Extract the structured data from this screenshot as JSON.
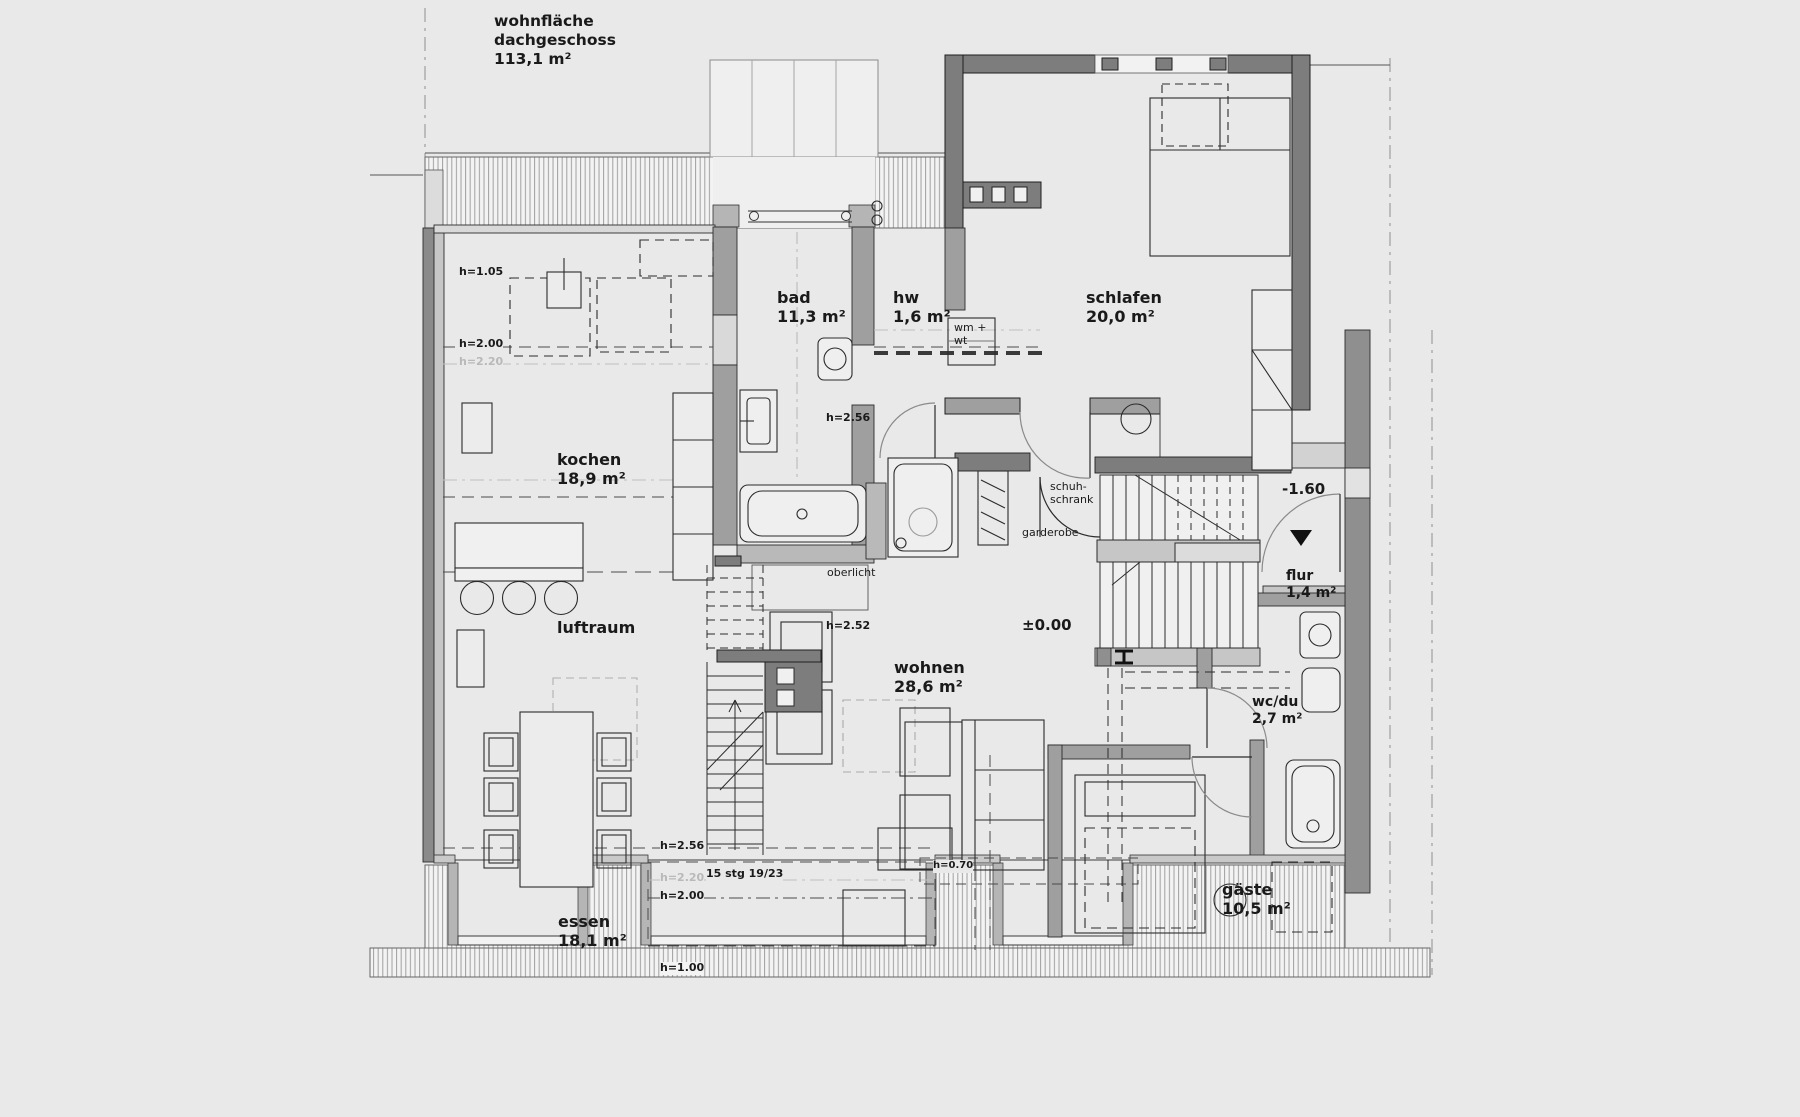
{
  "drawing": {
    "type": "floor-plan",
    "floor_area_note": "wohnfläche\ndachgeschoss\n113,1 m²",
    "level_markers": {
      "entry_level": "-1.60",
      "main_level": "±0.00"
    },
    "stair_note": "15 stg 19/23",
    "colors": {
      "background": "#e9e9e9",
      "wall_dark": "#7d7d7d",
      "wall_mid": "#9f9f9f",
      "wall_light": "#c6c6c6",
      "hatch_line": "#a0a0a0",
      "line": "#2b2b2b"
    }
  },
  "rooms": {
    "bad": "bad\n11,3 m²",
    "hw": "hw\n1,6 m²",
    "schlafen": "schlafen\n20,0 m²",
    "kochen": "kochen\n18,9 m²",
    "luftraum": "luftraum",
    "wohnen": "wohnen\n28,6 m²",
    "essen": "essen\n18,1 m²",
    "flur": "flur\n1,4 m²",
    "wcdu": "wc/du\n2,7 m²",
    "gaeste": "gäste\n10,5 m²"
  },
  "annotations": {
    "h105": "h=1.05",
    "h200_top": "h=2.00",
    "h220_top": "h=2.20",
    "h256_bad": "h=2.56",
    "h252": "h=2.52",
    "h256_bottom": "h=2.56",
    "h220_bottom": "h=2.20",
    "h200_bottom": "h=2.00",
    "h100": "h=1.00",
    "h070": "h=0.70",
    "oberlicht": "oberlicht",
    "schuhschrank": "schuh-\nschrank",
    "garderobe": "garderobe",
    "wm_wt": "wm +\nwt",
    "minus160": "-1.60",
    "pm000": "±0.00",
    "stg": "15 stg 19/23"
  }
}
